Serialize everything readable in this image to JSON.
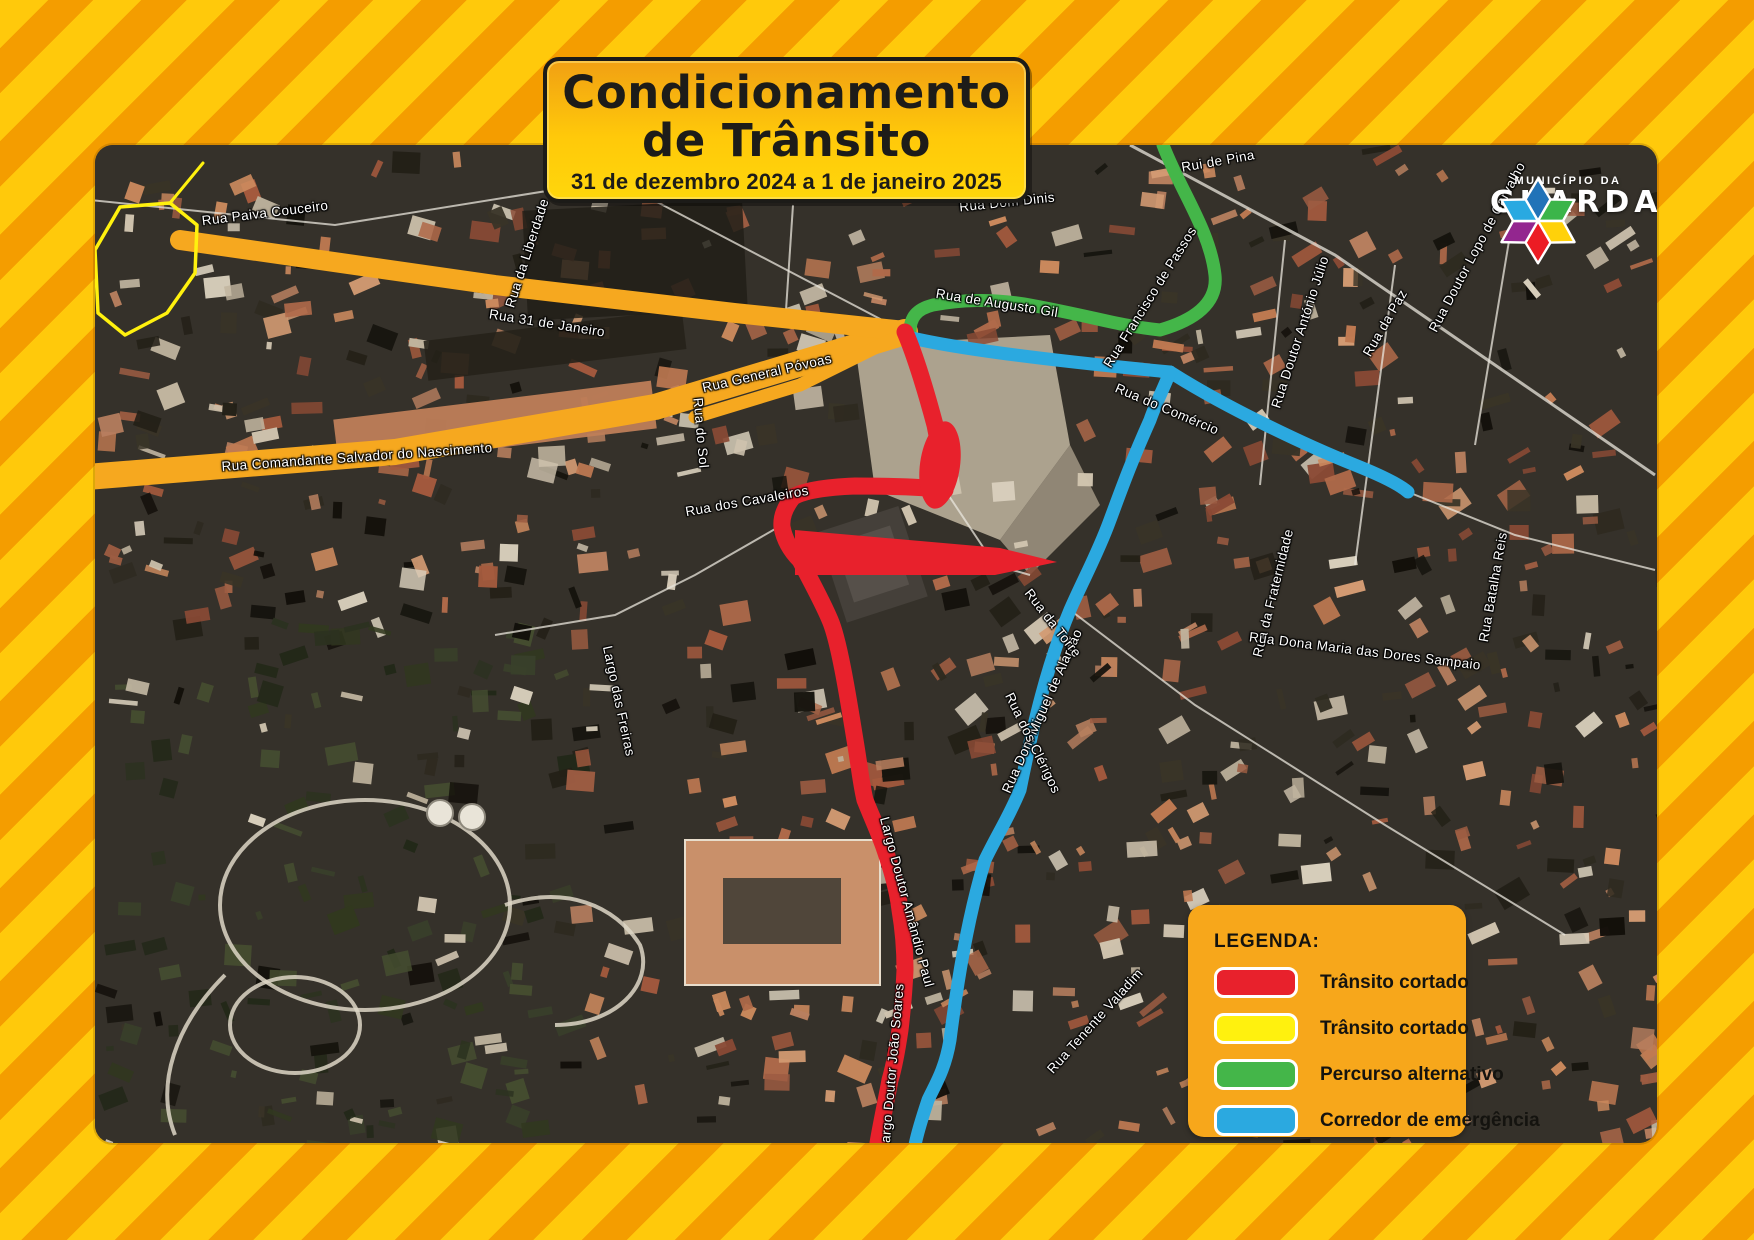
{
  "title_plate": {
    "line1": "Condicionamento",
    "line2": "de Trânsito",
    "subtitle": "31 de dezembro 2024 a 1 de janeiro 2025"
  },
  "logo": {
    "org_small": "MUNICÍPIO DA",
    "org_big": "GUARDA"
  },
  "legend": {
    "heading": "LEGENDA:",
    "items": [
      {
        "label": "Trânsito cortado",
        "color": "#e8212c"
      },
      {
        "label": "Trânsito cortado",
        "color": "#fff10e"
      },
      {
        "label": "Percurso alternativo",
        "color": "#44b649"
      },
      {
        "label": "Corredor de emergência",
        "color": "#2ba9e0"
      }
    ]
  },
  "colors": {
    "stripe_yellow": "#ffc90b",
    "stripe_orange": "#f49d00",
    "plate_orange": "#f7a71b",
    "route_red": "#e8212c",
    "route_yellow": "#fff10e",
    "route_green": "#44b649",
    "route_blue": "#2ba9e0",
    "road_orange": "#f6a81f",
    "logo_hex": [
      "#2173b8",
      "#3bb54a",
      "#ffd10a",
      "#ec1c24",
      "#93268f",
      "#29a9e1"
    ]
  },
  "map_labels": [
    {
      "text": "Rua Paiva Couceiro",
      "x": 170,
      "y": 68,
      "rot": -7
    },
    {
      "text": "Rua da Liberdade",
      "x": 432,
      "y": 108,
      "rot": -72
    },
    {
      "text": "Rua 31 de Janeiro",
      "x": 452,
      "y": 178,
      "rot": 9
    },
    {
      "text": "Rua General Póvoas",
      "x": 672,
      "y": 228,
      "rot": -13
    },
    {
      "text": "Rua Comandante Salvador do Nascimento",
      "x": 262,
      "y": 312,
      "rot": -4
    },
    {
      "text": "Rua do Sol",
      "x": 606,
      "y": 288,
      "rot": 85
    },
    {
      "text": "Rua dos Cavaleiros",
      "x": 652,
      "y": 356,
      "rot": -10
    },
    {
      "text": "Largo das Freiras",
      "x": 524,
      "y": 556,
      "rot": 78
    },
    {
      "text": "Largo Doutor Amândio Paul",
      "x": 812,
      "y": 757,
      "rot": 75
    },
    {
      "text": "Largo Doutor João Soares",
      "x": 797,
      "y": 922,
      "rot": -85
    },
    {
      "text": "Rua Dom Miguel de Alarcão",
      "x": 947,
      "y": 566,
      "rot": -66
    },
    {
      "text": "Rua de Augusto Gil",
      "x": 902,
      "y": 158,
      "rot": 9
    },
    {
      "text": "Rua Francisco de Passos",
      "x": 1055,
      "y": 152,
      "rot": -58
    },
    {
      "text": "Rua Dom Dinis",
      "x": 912,
      "y": 57,
      "rot": -6
    },
    {
      "text": "Rui de Pina",
      "x": 1123,
      "y": 16,
      "rot": -10
    },
    {
      "text": "Rua Doutor António Júlio",
      "x": 1205,
      "y": 187,
      "rot": -72
    },
    {
      "text": "Rua da Paz",
      "x": 1290,
      "y": 178,
      "rot": -60
    },
    {
      "text": "Rua Doutor Lopo de Carvalho",
      "x": 1382,
      "y": 102,
      "rot": -62
    },
    {
      "text": "Rua do Comércio",
      "x": 1072,
      "y": 264,
      "rot": 23
    },
    {
      "text": "Rua da Torre",
      "x": 958,
      "y": 478,
      "rot": 52
    },
    {
      "text": "Rua da Fraternidade",
      "x": 1178,
      "y": 448,
      "rot": -76
    },
    {
      "text": "Rua dos Clérigos",
      "x": 938,
      "y": 598,
      "rot": 64
    },
    {
      "text": "Rua Dona Maria das Dores Sampaio",
      "x": 1270,
      "y": 506,
      "rot": 7
    },
    {
      "text": "Rua Tenente Valadim",
      "x": 1000,
      "y": 876,
      "rot": -48
    },
    {
      "text": "Rua Batalha Reis",
      "x": 1398,
      "y": 442,
      "rot": -80
    }
  ]
}
